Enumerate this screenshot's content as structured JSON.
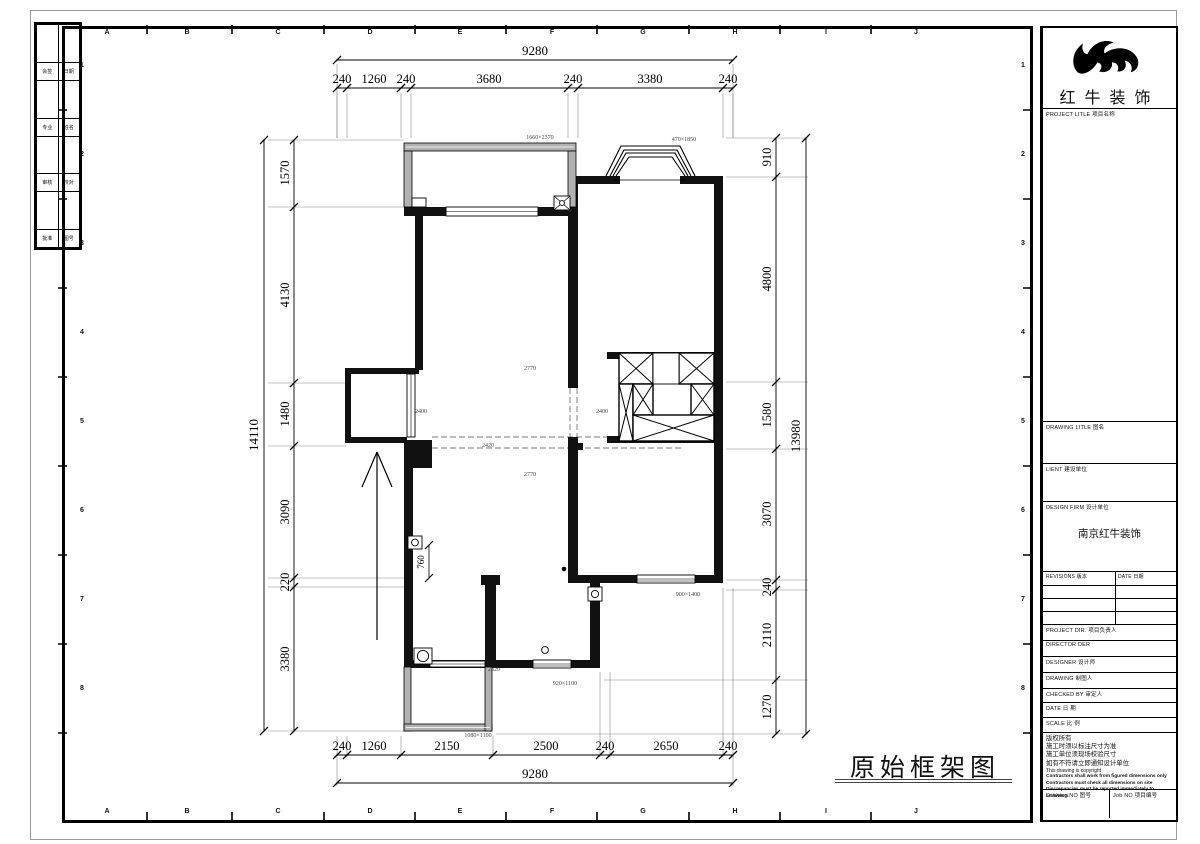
{
  "sheet": {
    "drawing_title": "原始框架图",
    "grid_columns": [
      "A",
      "B",
      "C",
      "D",
      "E",
      "F",
      "G",
      "H",
      "I",
      "J"
    ],
    "grid_rows": [
      "1",
      "2",
      "3",
      "4",
      "5",
      "6",
      "7",
      "8"
    ],
    "fold_strip": {
      "r1a": "会签",
      "r1b": "日期",
      "r2a": "专业",
      "r2b": "姓名",
      "r3a": "审核",
      "r3b": "校对",
      "r4a": "批准",
      "r4b": "图号"
    }
  },
  "title_block": {
    "company": "红牛装饰",
    "project_title_label": "PROJECT LITLE  项目名称",
    "drawing_title_label": "DRAWING LITLE  图名",
    "client_label": "LIENT  建设单位",
    "design_firm_label": "DESIGN FIRM  设计单位",
    "design_firm_value": "南京红牛装饰",
    "revisions_label": "REVISIONS  版本",
    "revision_date_label": "DATE  日期",
    "project_dir_label": "PROJECT DIR.  项目负责人",
    "director_label": "DIRECTOR DER",
    "designer_label": "DESIGNER      设计师",
    "drawing_label": "DRAWING       制图人",
    "checked_by_label": "CHECKED BY    审定人",
    "date_label": "DATE          日  期",
    "scale_label": "SCALE         比  例",
    "notes_cn": [
      "版权所有",
      "施工时须以标注尺寸为准",
      "施工单位须现场校验尺寸",
      "如有不符请立即通知设计单位"
    ],
    "notes_en": "This drawing is copyright",
    "notes_en_bold": [
      "Contractors shall work from figured dimensions only",
      "Contractors must check all dimensions on site",
      "Discrepancies must be reported immediately to architects"
    ],
    "drawing_no_label": "Drawing NO  图号",
    "job_no_label": "Job NO  项目编号"
  },
  "plan": {
    "dims_top_overall": "9280",
    "dims_top": [
      "240",
      "1260",
      "240",
      "3680",
      "240",
      "3380",
      "240"
    ],
    "dims_bottom": [
      "240",
      "1260",
      "2150",
      "2500",
      "240",
      "2650",
      "240"
    ],
    "dims_bottom_overall": "9280",
    "dims_left": [
      "1570",
      "4130",
      "1480",
      "3090",
      "220",
      "3380"
    ],
    "dims_left_overall": "14110",
    "dims_right": [
      "910",
      "4800",
      "1580",
      "3070",
      "240",
      "2110",
      "1270"
    ],
    "dims_right_overall": "13980",
    "labels": {
      "window_top": "1660×2370",
      "bay_window": "470×1850",
      "beam_1": "2770",
      "beam_2": "2770",
      "beam_3": "2400",
      "beam_4": "2400",
      "beam_5": "2420",
      "door_width": "760",
      "window_right": "900×1400",
      "window_mid": "920×1100",
      "window_balcony": "1080×1100",
      "sill": "2320"
    }
  },
  "colors": {
    "wall": "#000000",
    "window_wall": "#b1b1b1",
    "dash": "#777777"
  }
}
